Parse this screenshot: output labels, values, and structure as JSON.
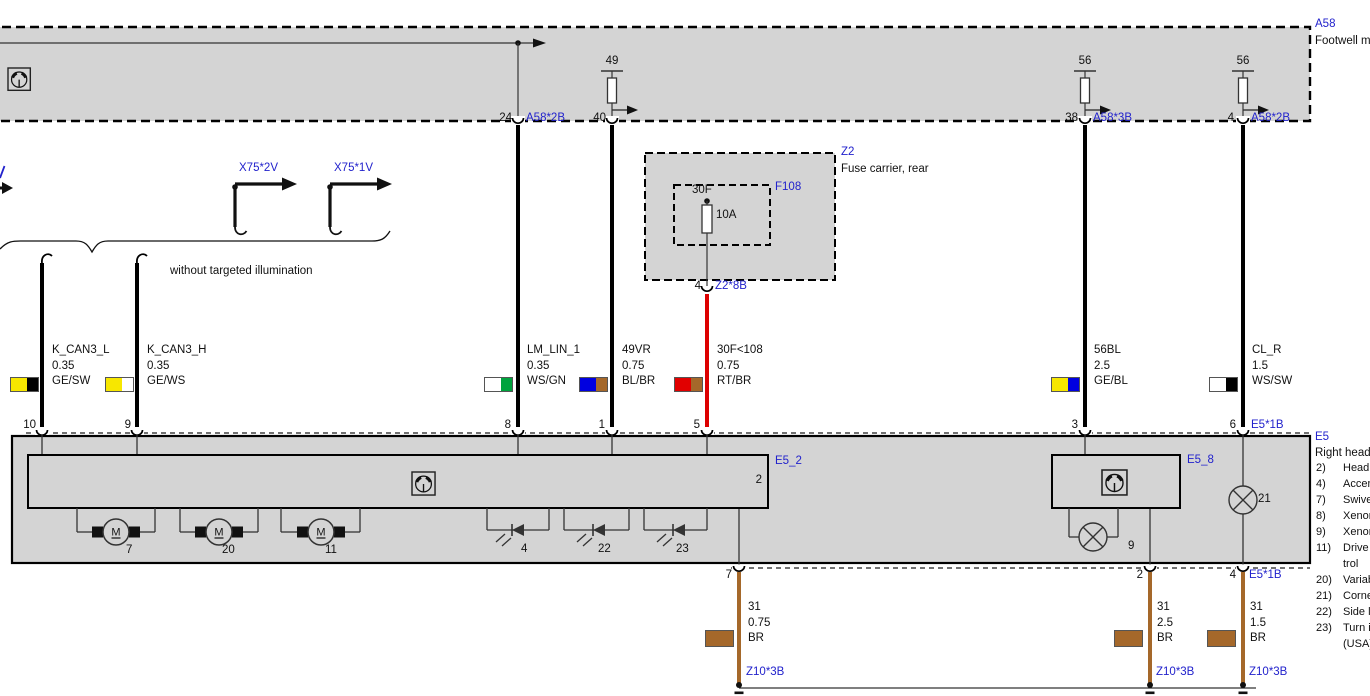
{
  "colors": {
    "module_fill": "#d4d4d4",
    "label_blue": "#2222cc",
    "wire_black": "#000000",
    "wire_red": "#dd0000",
    "wire_brown": "#a5682a",
    "ge_yellow": "#f7e700",
    "ws_white": "#ffffff",
    "gn_green": "#00a33e",
    "bl_blue": "#0000e0",
    "rt_red": "#e10000"
  },
  "a58": {
    "id": "A58",
    "name": "Footwell m",
    "terminal_49": "49",
    "terminal_56_left": "56",
    "terminal_56_right": "56",
    "pin24": "24",
    "pin24_conn": "A58*2B",
    "pin40": "40",
    "pin38": "38",
    "pin38_conn": "A58*3B",
    "pin4": "4",
    "pin4_conn": "A58*2B"
  },
  "branches": {
    "left_fragment": "",
    "x75_2v": "X75*2V",
    "x75_1v": "X75*1V",
    "note": "without targeted illumination"
  },
  "z2": {
    "id": "Z2",
    "name": "Fuse carrier, rear",
    "fuse": "F108",
    "terminal": "30F",
    "rating": "10A",
    "pin": "4",
    "pin_conn": "Z2*8B"
  },
  "wires": {
    "k_can3_l": {
      "name": "K_CAN3_L",
      "size": "0.35",
      "color": "GE/SW"
    },
    "k_can3_h": {
      "name": "K_CAN3_H",
      "size": "0.35",
      "color": "GE/WS"
    },
    "lm_lin_1": {
      "name": "LM_LIN_1",
      "size": "0.35",
      "color": "WS/GN"
    },
    "w49vr": {
      "name": "49VR",
      "size": "0.75",
      "color": "BL/BR"
    },
    "w30f108": {
      "name": "30F<108",
      "size": "0.75",
      "color": "RT/BR"
    },
    "w56bl": {
      "name": "56BL",
      "size": "2.5",
      "color": "GE/BL"
    },
    "cl_r": {
      "name": "CL_R",
      "size": "1.5",
      "color": "WS/SW"
    }
  },
  "e5": {
    "id": "E5",
    "name": "Right head",
    "connector_top": "E5*1B",
    "connector_bottom": "E5*1B",
    "pins_top": {
      "p10": "10",
      "p9": "9",
      "p8": "8",
      "p1": "1",
      "p5": "5",
      "p3": "3",
      "p6": "6"
    },
    "pins_bottom": {
      "p7": "7",
      "p2": "2",
      "p4": "4"
    },
    "sub2": {
      "id": "E5_2",
      "pin": "2"
    },
    "sub8": {
      "id": "E5_8"
    },
    "motor_letter": "M",
    "motor1": "7",
    "motor2": "20",
    "motor3": "11",
    "led1": "4",
    "led2": "22",
    "led3": "23",
    "lamp9": "9",
    "lamp21": "21",
    "legend": [
      {
        "num": "2)",
        "text": "Headl"
      },
      {
        "num": "4)",
        "text": "Accen"
      },
      {
        "num": "7)",
        "text": "Swive"
      },
      {
        "num": "8)",
        "text": "Xenon"
      },
      {
        "num": "9)",
        "text": "Xenon"
      },
      {
        "num": "11)",
        "text": "Drive u"
      },
      {
        "num": "",
        "text": "trol"
      },
      {
        "num": "20)",
        "text": "Variab"
      },
      {
        "num": "21)",
        "text": "Corne"
      },
      {
        "num": "22)",
        "text": "Side li"
      },
      {
        "num": "23)",
        "text": "Turn i"
      },
      {
        "num": "",
        "text": "(USA)"
      }
    ]
  },
  "grounds": {
    "g1": {
      "name": "31",
      "size": "0.75",
      "color": "BR",
      "stud": "Z10*3B"
    },
    "g2": {
      "name": "31",
      "size": "2.5",
      "color": "BR",
      "stud": "Z10*3B"
    },
    "g3": {
      "name": "31",
      "size": "1.5",
      "color": "BR",
      "stud": "Z10*3B"
    }
  }
}
